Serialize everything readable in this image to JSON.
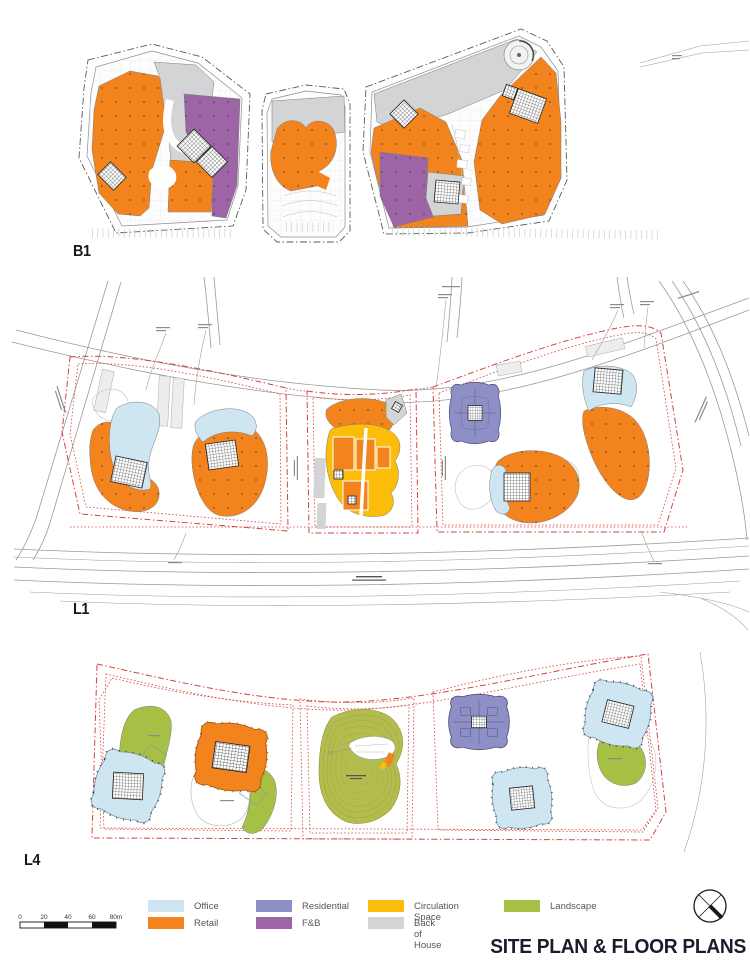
{
  "plan_labels": {
    "b1": "B1",
    "l1": "L1",
    "l4": "L4"
  },
  "legend": {
    "items": [
      {
        "label": "Office",
        "color": "#CDE6F2"
      },
      {
        "label": "Retail",
        "color": "#F2831D"
      },
      {
        "label": "Residential",
        "color": "#8D8FC6"
      },
      {
        "label": "F&B",
        "color": "#9D64A6"
      },
      {
        "label": "Circulation Space",
        "color": "#FBBD09"
      },
      {
        "label": "Back of House",
        "color": "#D2D4D6"
      },
      {
        "label": "Landscape",
        "color": "#A6C045"
      }
    ]
  },
  "colors": {
    "office": "#CDE6F2",
    "retail": "#F2831D",
    "residential": "#8D8FC6",
    "fnb": "#9D64A6",
    "circulation": "#FBBD09",
    "boh": "#D2D4D6",
    "landscape": "#A6C045",
    "landscape_mound": "#B3BC4F",
    "boundary_red": "#D9403E",
    "road": "#9A9A9A",
    "title": "#1B1B2B"
  },
  "scale_bar": {
    "ticks": [
      "0",
      "20",
      "40",
      "60",
      "80m"
    ]
  },
  "title": "SITE PLAN & FLOOR PLANS"
}
